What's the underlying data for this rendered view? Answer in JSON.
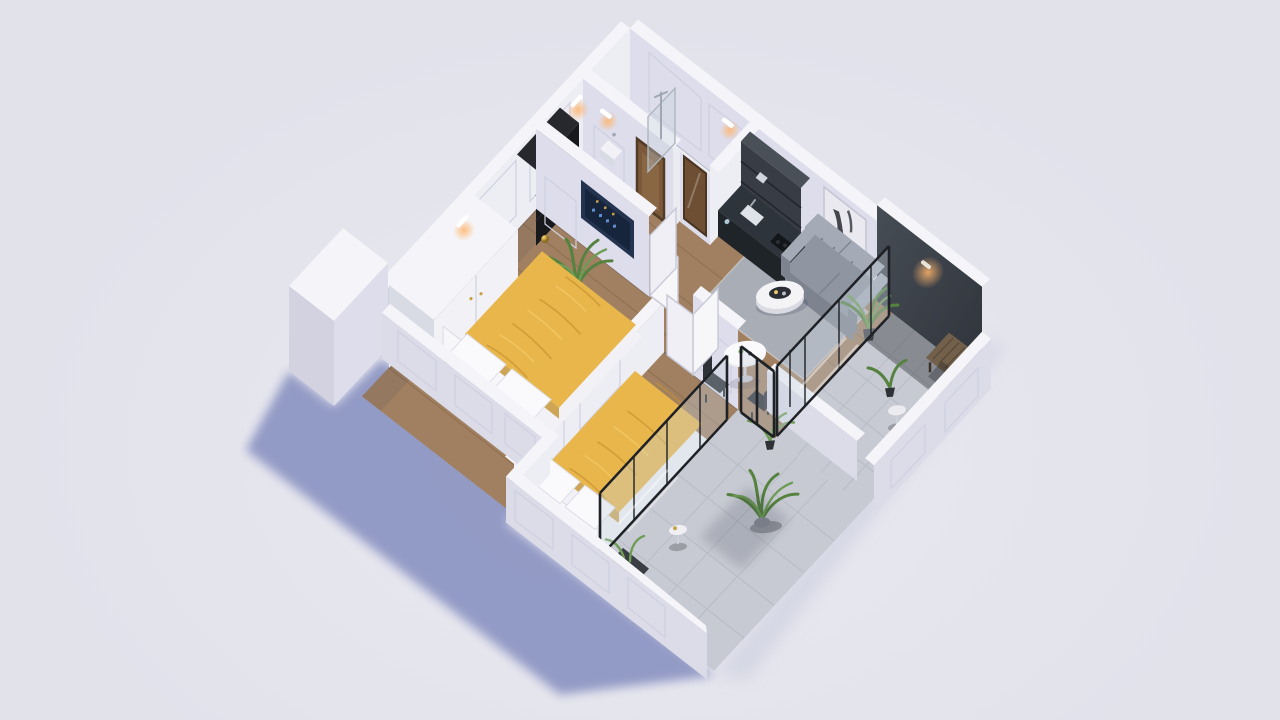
{
  "title": "Isometric 3D floor-plan render of a two-bedroom apartment",
  "colors": {
    "bg": "#e2e2eb",
    "bgLight": "#e9e9f1",
    "shadow": "#8a93c1",
    "shadowSoft": "#c9ccdd",
    "wallTop": "#f5f5f9",
    "wallFaceLight": "#ededf4",
    "wallFaceShade": "#ddddec",
    "wallOuter": "#d2d2e1",
    "kneeOuter": "#dcdce9",
    "panelLine": "#cfd0e0",
    "wood": "#a08061",
    "bathFloor": "#eaecf2",
    "tile": "#c7cad2",
    "tileLine": "#afb3bd",
    "darkWall": "#474d55",
    "darkWallDeep": "#2f343b",
    "rug": "#a9adb6",
    "sofa": "#8f96a1",
    "sofaLight": "#a4abb6",
    "sofaDark": "#7d8490",
    "duvet": "#e9b64b",
    "duvetLight": "#f4ca67",
    "duvetShadow": "#c4912c",
    "furnWhite": "#f2f2f6",
    "furnShade": "#d8dae4",
    "gold": "#c9a23f",
    "goldDeep": "#8a6c20",
    "closet": "#17191d",
    "kitchenDark": "#383d45",
    "counterTop": "#2e343b",
    "counterFront": "#1f2429",
    "tv": "#24344f",
    "tvScreen": "#16243c",
    "doorBrown": "#7a5839",
    "doorFrame": "#523c27",
    "glass": "rgba(199,210,220,0.35)",
    "glassFrame": "#1e2125",
    "green": "#55823f",
    "greenLight": "#6f9c55",
    "bench": "#72604b",
    "glow": "#ffb46b"
  },
  "scene": {
    "style": "isometric dollhouse cutaway, knee-height front walls, full-height back walls",
    "rooms": [
      {
        "id": "bedroom-1",
        "floor": "wood",
        "contents": [
          "double-bed-yellow",
          "wardrobe",
          "smart-panel-tv",
          "wall-sconces",
          "gold-sphere-lamps",
          "palm-plant"
        ]
      },
      {
        "id": "bedroom-2",
        "floor": "wood",
        "contents": [
          "double-bed-yellow",
          "gold-sphere-lamps",
          "glass-partition"
        ]
      },
      {
        "id": "entry-hall",
        "floor": "wood",
        "contents": [
          "black-closet",
          "open-double-doors"
        ]
      },
      {
        "id": "bathroom",
        "floor": "light-tile",
        "contents": [
          "shower-glass",
          "chrome-shower-pole",
          "sink",
          "wood-framed-door",
          "mirror-panel"
        ]
      },
      {
        "id": "kitchen",
        "floor": "wood",
        "contents": [
          "dark-cabinets",
          "counter-with-sink",
          "cooktop"
        ]
      },
      {
        "id": "living-dining",
        "floor": "wood",
        "contents": [
          "gray-sofa",
          "wall-artwork",
          "gray-rug",
          "round-coffee-table",
          "dining-table",
          "two-black-chairs",
          "corner-plant"
        ]
      },
      {
        "id": "balcony-main",
        "floor": "gray-tile",
        "contents": [
          "dark-feature-walls",
          "wall-lamp-glow",
          "wood-bench",
          "side-table",
          "glass-sliding-wall"
        ]
      },
      {
        "id": "balcony-bedroom",
        "floor": "gray-tile",
        "contents": [
          "monstera-plant",
          "small-plant",
          "side-table",
          "dark-planter",
          "glass-partition"
        ]
      }
    ],
    "lighting": {
      "sun": "upper-left",
      "cast_shadow": "blue-violet toward lower-left",
      "sconces": "warm"
    }
  }
}
